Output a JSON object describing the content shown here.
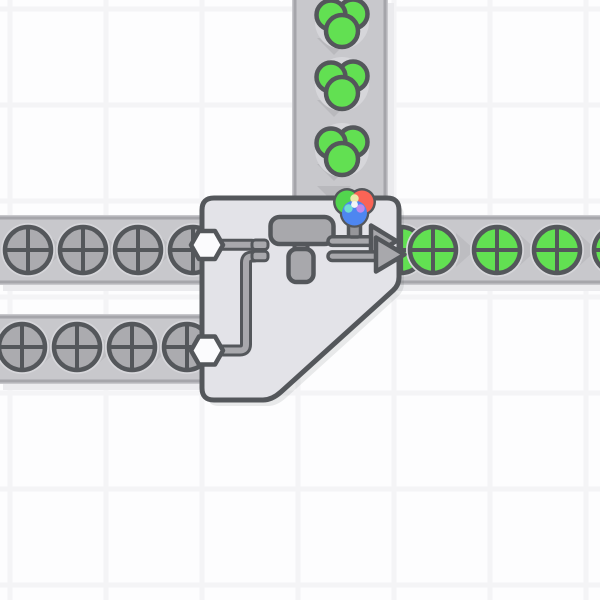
{
  "app": {
    "name": "factory-automation-game-viewport",
    "scene": "double-painter-painting-circles-green"
  },
  "viewport": {
    "width": 600,
    "height": 600
  },
  "palette": {
    "background": "#fdfdfe",
    "grid_line": "#f4f4f6",
    "belt_fill": "#c8c8cc",
    "belt_border": "#a5a5aa",
    "belt_shadow": "#ebebee",
    "chevron_vertical": "#b9b9bd",
    "chevron_horizontal": "#bdbdc1",
    "item_halo": "#d6d6da",
    "outline_dark": "#54575b",
    "uncolored_fill": "#ababaf",
    "green_fill": "#62e052",
    "building_fill": "#e3e3e8",
    "building_shadow": "rgba(84,87,91,0.12)",
    "machine_fill": "#a8a8ac",
    "hexagon_fill": "#fbfbfd",
    "pin_fill": "#96969a",
    "indicator_red": "#fa6456",
    "indicator_green": "#52d54e",
    "indicator_blue": "#4e86f0",
    "indicator_yellow": "#ece9ac",
    "indicator_cyan": "#6fdcd4",
    "indicator_magenta": "#c088ea",
    "indicator_white": "#f2f4f6",
    "none": "none"
  },
  "grid": {
    "tile_size": 96,
    "line_width": 5,
    "vertical_lines": [
      10,
      106,
      202,
      298,
      394,
      490,
      586
    ],
    "horizontal_lines": [
      9,
      105,
      201,
      297,
      393,
      489,
      585
    ]
  },
  "belts": [
    {
      "name": "conveyor-belt-color-input",
      "orientation": "vertical",
      "direction": "down",
      "x": 292,
      "y": 0,
      "width": 96,
      "length": 206,
      "chevrons": [
        46,
        108,
        172,
        194
      ]
    },
    {
      "name": "conveyor-belt-upper-left",
      "orientation": "horizontal",
      "direction": "right",
      "x": 0,
      "y": 215,
      "width": 70,
      "length": 206,
      "chevrons": [
        55.5,
        110.5,
        165.5
      ]
    },
    {
      "name": "conveyor-belt-lower-left",
      "orientation": "horizontal",
      "direction": "right",
      "x": 0,
      "y": 314,
      "width": 70,
      "length": 206,
      "chevrons": [
        49.5,
        104.5,
        159.5
      ]
    },
    {
      "name": "conveyor-belt-output",
      "orientation": "horizontal",
      "direction": "right",
      "x": 394,
      "y": 215,
      "width": 70,
      "length": 206,
      "chevrons": [
        420,
        465,
        527,
        587
      ]
    }
  ],
  "items": [
    {
      "name": "item-color-green",
      "type": "color",
      "color_key": "green_fill",
      "x": 342,
      "y": 22
    },
    {
      "name": "item-color-green",
      "type": "color",
      "color_key": "green_fill",
      "x": 342,
      "y": 84
    },
    {
      "name": "item-color-green",
      "type": "color",
      "color_key": "green_fill",
      "x": 342,
      "y": 150
    },
    {
      "name": "item-circle-uncolored",
      "type": "shape_circle",
      "color_key": "uncolored_fill",
      "x": 28,
      "y": 250
    },
    {
      "name": "item-circle-uncolored",
      "type": "shape_circle",
      "color_key": "uncolored_fill",
      "x": 83,
      "y": 250
    },
    {
      "name": "item-circle-uncolored",
      "type": "shape_circle",
      "color_key": "uncolored_fill",
      "x": 138,
      "y": 250
    },
    {
      "name": "item-circle-uncolored",
      "type": "shape_circle",
      "color_key": "uncolored_fill",
      "x": 193,
      "y": 250
    },
    {
      "name": "item-circle-uncolored",
      "type": "shape_circle",
      "color_key": "uncolored_fill",
      "x": 22,
      "y": 347
    },
    {
      "name": "item-circle-uncolored",
      "type": "shape_circle",
      "color_key": "uncolored_fill",
      "x": 77,
      "y": 347
    },
    {
      "name": "item-circle-uncolored",
      "type": "shape_circle",
      "color_key": "uncolored_fill",
      "x": 132,
      "y": 347
    },
    {
      "name": "item-circle-uncolored",
      "type": "shape_circle",
      "color_key": "uncolored_fill",
      "x": 187,
      "y": 347
    },
    {
      "name": "item-circle-green",
      "type": "shape_circle",
      "color_key": "green_fill",
      "x": 401,
      "y": 250
    },
    {
      "name": "item-circle-green",
      "type": "shape_circle",
      "color_key": "green_fill",
      "x": 433,
      "y": 250
    },
    {
      "name": "item-circle-green",
      "type": "shape_circle",
      "color_key": "green_fill",
      "x": 497,
      "y": 250
    },
    {
      "name": "item-circle-green",
      "type": "shape_circle",
      "color_key": "green_fill",
      "x": 557,
      "y": 250
    },
    {
      "name": "item-circle-green",
      "type": "shape_circle",
      "color_key": "green_fill",
      "x": 617,
      "y": 250
    }
  ],
  "building": {
    "name": "painter-double-building",
    "footprint": {
      "x": 202,
      "y": 198,
      "width": 197,
      "height": 202
    },
    "body_path": "M 214,198 H 387 Q 399,198 399,210 V 277 Q 399,285 393.1,290.4 L 281,391.9 Q 272,400 263,400 H 214 Q 202,400 202,388 V 210 Q 202,198 214,198 Z",
    "parts": [
      {
        "kind": "path",
        "name": "building-shadow",
        "d": "body",
        "fill": "building_shadow",
        "transform": "translate(5,6)"
      },
      {
        "kind": "path",
        "name": "building-body",
        "d": "body",
        "fill": "building_fill",
        "stroke": "outline_dark",
        "sw": 5
      },
      {
        "kind": "path",
        "name": "input-pipe-upper-outline",
        "d": "M 218 244.7 H 252",
        "fill": "none",
        "stroke": "outline_dark",
        "sw": 12
      },
      {
        "kind": "path",
        "name": "input-pipe-upper",
        "d": "M 218 244.7 H 252",
        "fill": "none",
        "stroke": "machine_fill",
        "sw": 6
      },
      {
        "kind": "path",
        "name": "input-pipe-lower-outline",
        "d": "M 218 350.5 H 240 Q 246 350.5 246 344.5 V 262.5 Q 246 256.5 252 256.5 H 254",
        "fill": "none",
        "stroke": "outline_dark",
        "sw": 12
      },
      {
        "kind": "path",
        "name": "input-pipe-lower",
        "d": "M 218 350.5 H 240 Q 246 350.5 246 344.5 V 262.5 Q 246 256.5 252 256.5 H 254",
        "fill": "none",
        "stroke": "machine_fill",
        "sw": 6
      },
      {
        "kind": "rect",
        "name": "pipe-flange-upper",
        "x": 252,
        "y": 240,
        "w": 16,
        "h": 9.5,
        "r": 3.5,
        "fill": "machine_fill",
        "stroke": "outline_dark",
        "sw": 3
      },
      {
        "kind": "rect",
        "name": "pipe-flange-lower",
        "x": 252,
        "y": 251.3,
        "w": 16,
        "h": 9.5,
        "r": 3.5,
        "fill": "machine_fill",
        "stroke": "outline_dark",
        "sw": 3
      },
      {
        "kind": "polygon",
        "name": "input-port-hexagon-upper",
        "pts": "191,245 199,231 215,231 223,245 215,259 199,259",
        "fill": "hexagon_fill",
        "stroke": "outline_dark",
        "sw": 4.5
      },
      {
        "kind": "polygon",
        "name": "input-port-hexagon-lower",
        "pts": "191,350.5 199,336.5 215,336.5 223,350.5 215,364.5 199,364.5",
        "fill": "hexagon_fill",
        "stroke": "outline_dark",
        "sw": 4.5
      },
      {
        "kind": "rect",
        "name": "paint-roller-stem",
        "x": 294.5,
        "y": 236,
        "w": 13,
        "h": 18,
        "r": 3,
        "fill": "machine_fill",
        "stroke": "outline_dark",
        "sw": 4
      },
      {
        "kind": "rect",
        "name": "paint-roller-body",
        "x": 270.5,
        "y": 217,
        "w": 63,
        "h": 27,
        "r": 9,
        "fill": "machine_fill",
        "stroke": "outline_dark",
        "sw": 4.5
      },
      {
        "kind": "rect",
        "name": "paint-roller-handle",
        "x": 288.5,
        "y": 249,
        "w": 25,
        "h": 33,
        "r": 8,
        "fill": "machine_fill",
        "stroke": "outline_dark",
        "sw": 4.5
      },
      {
        "kind": "rect",
        "name": "output-arrow-back-shaft",
        "x": 328,
        "y": 236.8,
        "w": 47,
        "h": 8.6,
        "r": 4.3,
        "fill": "machine_fill",
        "stroke": "outline_dark",
        "sw": 3.5
      },
      {
        "kind": "polygon",
        "name": "output-arrow-back-head",
        "pts": "371,225.5 371,256.5 396.5,241",
        "fill": "machine_fill",
        "stroke": "outline_dark",
        "sw": 4.5
      },
      {
        "kind": "rect",
        "name": "output-arrow-front-shaft",
        "x": 328,
        "y": 251.9,
        "w": 53,
        "h": 8.6,
        "r": 4.3,
        "fill": "machine_fill",
        "stroke": "outline_dark",
        "sw": 3.5
      },
      {
        "kind": "polygon",
        "name": "output-arrow-front-head",
        "pts": "376,237.5 376,271.5 404.5,254.5",
        "fill": "machine_fill",
        "stroke": "outline_dark",
        "sw": 4.5
      },
      {
        "kind": "rect",
        "name": "color-indicator-pin",
        "x": 348.5,
        "y": 223,
        "w": 12,
        "h": 14,
        "r": 2.5,
        "fill": "pin_fill",
        "stroke": "outline_dark",
        "sw": 3.5
      },
      {
        "kind": "circle",
        "name": "color-indicator-outline",
        "cx": 347,
        "cy": 202,
        "rr": 14,
        "fill": "outline_dark"
      },
      {
        "kind": "circle",
        "name": "color-indicator-outline",
        "cx": 362,
        "cy": 202,
        "rr": 14,
        "fill": "outline_dark"
      },
      {
        "kind": "circle",
        "name": "color-indicator-outline",
        "cx": 354.5,
        "cy": 213,
        "rr": 14.8,
        "fill": "outline_dark"
      },
      {
        "kind": "circle",
        "name": "color-indicator-green",
        "cx": 347,
        "cy": 202,
        "rr": 11.5,
        "fill": "indicator_green"
      },
      {
        "kind": "circle",
        "name": "color-indicator-red",
        "cx": 362,
        "cy": 202,
        "rr": 11.5,
        "fill": "indicator_red"
      },
      {
        "kind": "circle",
        "name": "color-indicator-blue",
        "cx": 354.5,
        "cy": 213,
        "rr": 12.5,
        "fill": "indicator_blue"
      },
      {
        "kind": "circle",
        "name": "color-indicator-yellow-mix",
        "cx": 354.5,
        "cy": 198.5,
        "rr": 4.2,
        "fill": "indicator_yellow"
      },
      {
        "kind": "circle",
        "name": "color-indicator-cyan-mix",
        "cx": 348.5,
        "cy": 208.5,
        "rr": 4.2,
        "fill": "indicator_cyan"
      },
      {
        "kind": "circle",
        "name": "color-indicator-magenta-mix",
        "cx": 360.5,
        "cy": 208.5,
        "rr": 4.2,
        "fill": "indicator_magenta"
      },
      {
        "kind": "circle",
        "name": "color-indicator-white-mix",
        "cx": 354.5,
        "cy": 204.5,
        "rr": 3.4,
        "fill": "indicator_white"
      }
    ]
  }
}
